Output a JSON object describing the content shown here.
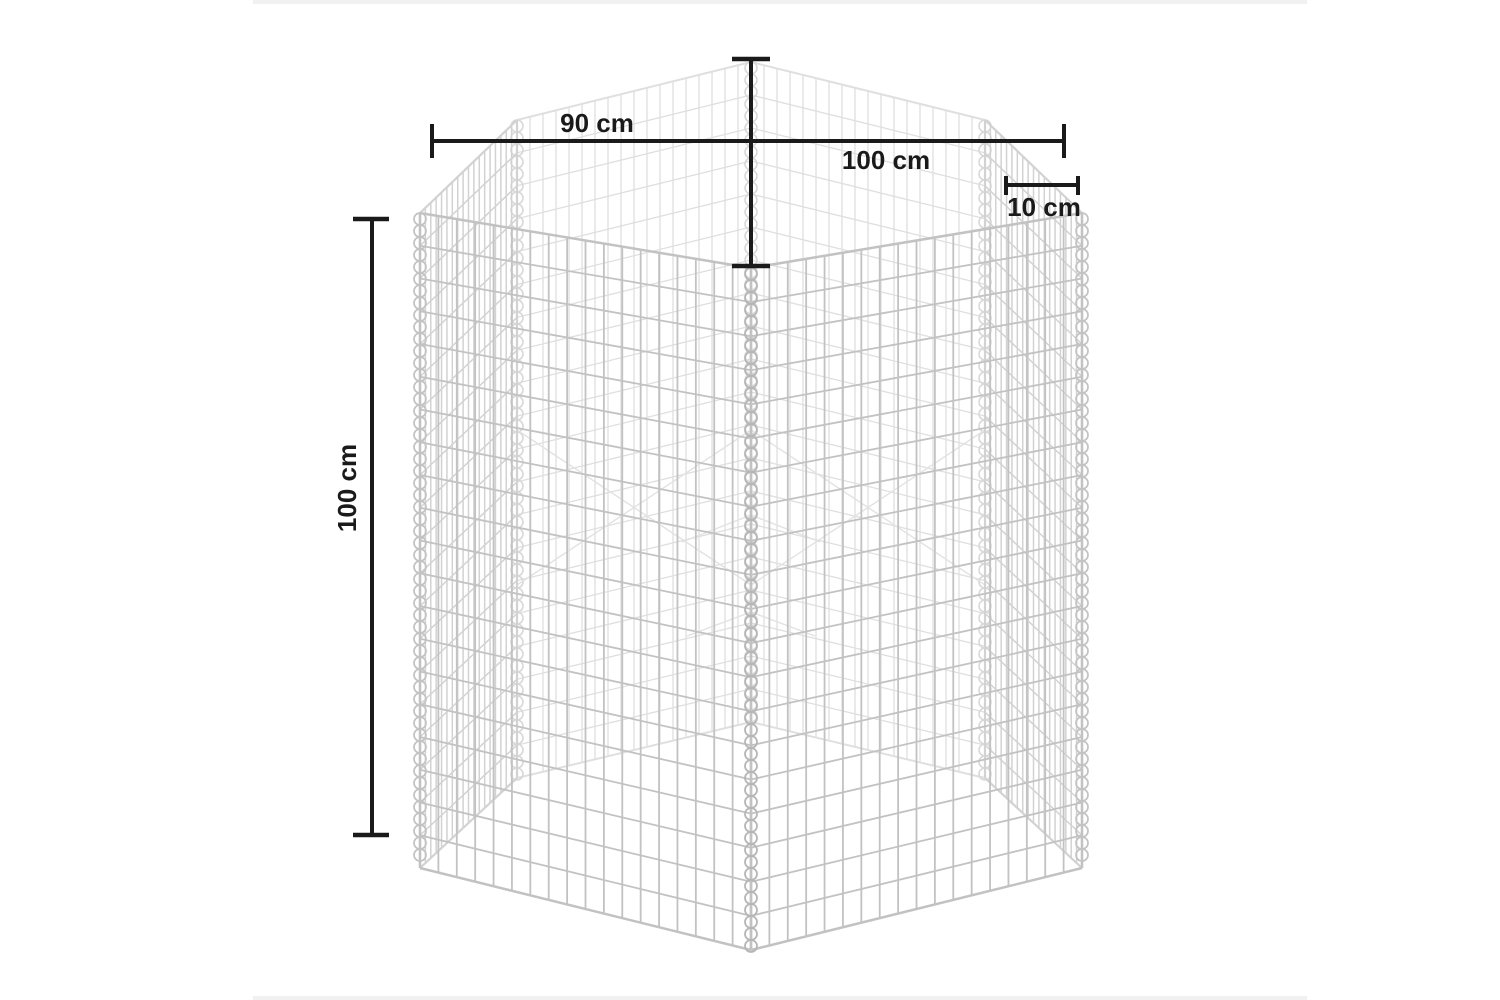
{
  "figure": {
    "subject": "Hexagonal gabion wire-mesh basket dimension drawing",
    "view": "three-quarter wireframe render, grey wires, black dimension annotations"
  },
  "dimensions": {
    "top_inner_width": {
      "label": "90 cm",
      "value": 90,
      "unit": "cm"
    },
    "top_outer_width": {
      "label": "100 cm",
      "value": 100,
      "unit": "cm"
    },
    "wall_offset": {
      "label": "10 cm",
      "value": 10,
      "unit": "cm"
    },
    "height": {
      "label": "100 cm",
      "value": 100,
      "unit": "cm"
    }
  },
  "colors": {
    "dimension_line": "#1a1a1a",
    "wire_front": "#c2c2c2",
    "wire_side": "#d2d2d2",
    "wire_back": "#dfdfdf",
    "coil_front": "#b6b6b6",
    "coil_back": "#d8d8d8",
    "background": "#ffffff",
    "edge_strip": "#f1f1f1"
  }
}
